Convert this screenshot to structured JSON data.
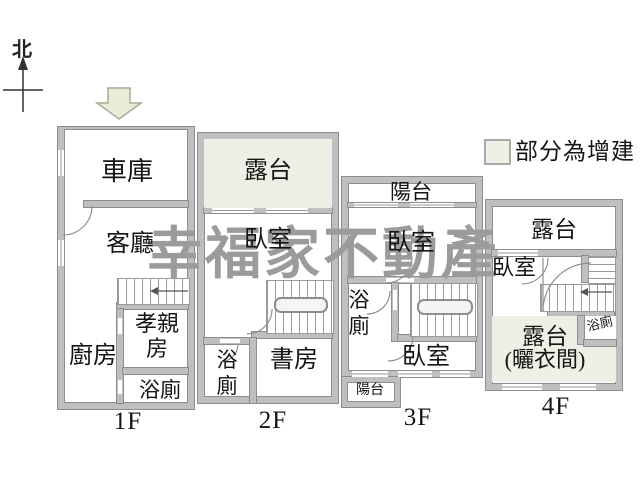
{
  "compass": {
    "north_label": "北"
  },
  "legend": {
    "label": "部分為增建",
    "addition_color": "#edf1e5"
  },
  "watermark": {
    "text": "幸福家不動產",
    "color": "#9b9b9b"
  },
  "colors": {
    "wall": "#bfbfbf",
    "wall_edge": "#8d8d8d",
    "addition_green": "#edf1e5",
    "entry_arrow_fill": "#e9ecd6"
  },
  "floors": [
    {
      "label": "1F",
      "rooms": {
        "garage": "車庫",
        "living": "客廳",
        "kitchen": "廚房",
        "parents": "孝親房",
        "bath": "浴廁"
      }
    },
    {
      "label": "2F",
      "rooms": {
        "terrace": "露台",
        "bedroom": "臥室",
        "bath": "浴廁",
        "study": "書房"
      }
    },
    {
      "label": "3F",
      "rooms": {
        "balcony_top": "陽台",
        "bedroom_top": "臥室",
        "bath": "浴廁",
        "bedroom_bottom": "臥室",
        "balcony_bottom": "陽台"
      }
    },
    {
      "label": "4F",
      "rooms": {
        "terrace_top": "露台",
        "bedroom": "臥室",
        "bath": "浴廁",
        "terrace_bottom": "露台",
        "terrace_bottom_sub": "(曬衣間)"
      }
    }
  ]
}
